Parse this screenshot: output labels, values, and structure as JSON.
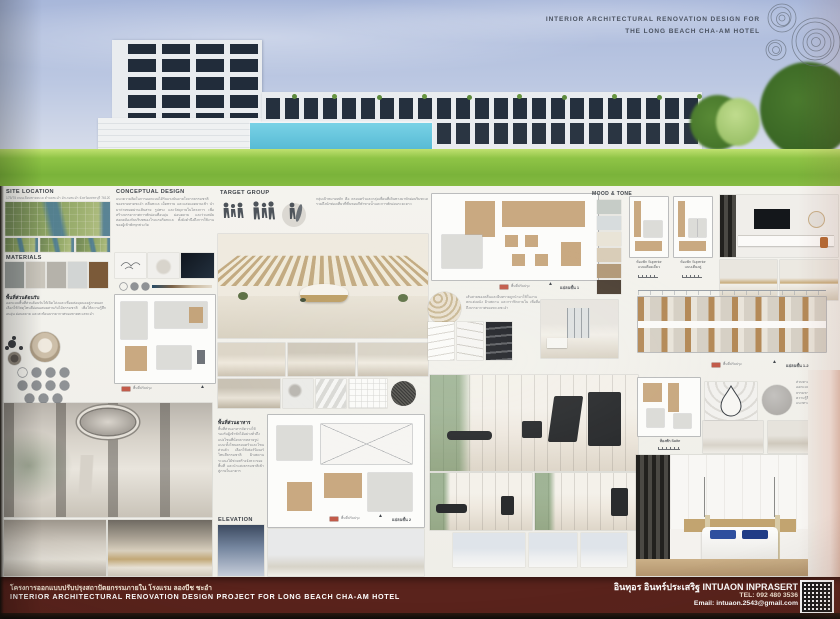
{
  "board": {
    "title_line1": "INTERIOR ARCHITECTURAL RENOVATION DESIGN FOR",
    "title_line2": "THE LONG BEACH CHA-AM HOTEL"
  },
  "site": {
    "heading": "SITE LOCATION",
    "address": "175/75 ถนนเลียบชายทะเล ตำบลชะอำ อำเภอชะอำ จังหวัดเพชรบุรี 76120"
  },
  "concept": {
    "heading": "CONCEPTUAL DESIGN",
    "body": "แนวความคิดในการออกแบบได้รับแรงบันดาลใจจากธรรมชาติของชายหาดชะอำ คลื่นทะเล เม็ดทราย และแสงแดดยามเช้า นำมาถ่ายทอดผ่านเส้นสาย รูปทรง และวัสดุภายในโครงการ เพื่อสร้างบรรยากาศการพักผ่อนที่อบอุ่น ผ่อนคลาย และร่วมสมัย สอดคล้องกับบริบทของโรงแรมริมทะเล ทั้งยังคำนึงถึงการใช้งานของผู้เข้าพักทุกช่วงวัย"
  },
  "target": {
    "heading": "TARGET GROUP",
    "body": "กลุ่มเป้าหมายหลัก คือ ครอบครัวและกลุ่มเพื่อนที่เดินทางมาพักผ่อนริมทะเล รวมถึงนักท่องเที่ยวที่ชื่นชอบกีฬาทางน้ำและการพักผ่อนระยะยาว"
  },
  "mood": {
    "heading": "MOOD & TONE",
    "palette": [
      "#c6ccc7",
      "#d7dcdd",
      "#e9e4d7",
      "#d9cdb8",
      "#b39a79",
      "#4f4337"
    ]
  },
  "materials": {
    "heading": "MATERIALS",
    "swatches": [
      "#969b98",
      "#cac6bc",
      "#b5b2aa",
      "#d2d5d4",
      "#7b5a39"
    ]
  },
  "reception": {
    "heading": "พื้นที่ส่วนต้อนรับ",
    "body": "ออกแบบพื้นที่ส่วนต้อนรับให้เปิดโล่งและเชื่อมต่อมุมมองสู่ภายนอก เลือกใช้วัสดุโทนสีอ่อนผสมผสานกับไม้ธรรมชาติ เพื่อให้ความรู้สึกอบอุ่น ผ่อนคลาย และสะท้อนบรรยากาศของชายทะเลชะอำ"
  },
  "dining": {
    "heading": "พื้นที่ส่วนอาหาร",
    "body": "พื้นที่ส่วนอาหารจัดวางให้รองรับผู้เข้าพักได้อย่างทั่วถึง แบ่งโซนที่นั่งหลากหลายรูปแบบ ทั้งโซนครอบครัวและโซนส่วนตัว เลือกใช้เฟอร์นิเจอร์โทนสีธรรมชาติ ฝ้าเพดานระแนงไม้ช่วยสร้างจังหวะของพื้นที่ และนำแสงธรรมชาติเข้าสู่ภายในอาคาร"
  },
  "notes": {
    "wave": "เส้นสายของคลื่นและผืนทรายถูกนำมาใช้ในงานตกแต่งผนัง ฝ้าเพดาน และกราฟิกภายใน เพื่อสื่อถึงบรรยากาศของทะเลชะอำ",
    "suite": "ส่วนทางเดินหน้าห้องพักออกแบบให้โปร่งโล่ง มีแสงธรรมชาติ และใช้วัสดุไม้ให้ความรู้สึกอบอุ่นตลอดแนวทางเดิน"
  },
  "elevation_heading": "ELEVATION",
  "plans": {
    "plan1": "แปลนชั้น 1",
    "plan2": "แปลนชั้น 2",
    "plan12": "แปลนชั้น 1-2",
    "legend": "พื้นที่ปรับปรุง"
  },
  "rooms": {
    "superior_single_1": "ห้องพัก Superior",
    "superior_single_2": "แบบเตียงเดี่ยว",
    "superior_twin_1": "ห้องพัก Superior",
    "superior_twin_2": "แบบเตียงคู่",
    "suite": "ห้องพัก Suite"
  },
  "footer": {
    "project_th": "โครงการออกแบบปรับปรุงสถาปัตยกรรมภายใน โรงแรม ลองบีช ชะอำ",
    "project_en": "INTERIOR ARCHITECTURAL RENOVATION DESIGN PROJECT FOR LONG BEACH CHA-AM HOTEL",
    "designer": "อินทุอร อินทร์ประเสริฐ INTUAON INPRASERT",
    "tel": "TEL: 092 480 3536",
    "email": "Email: intuaon.2543@gmail.com",
    "banner_color": "#5a231c"
  }
}
